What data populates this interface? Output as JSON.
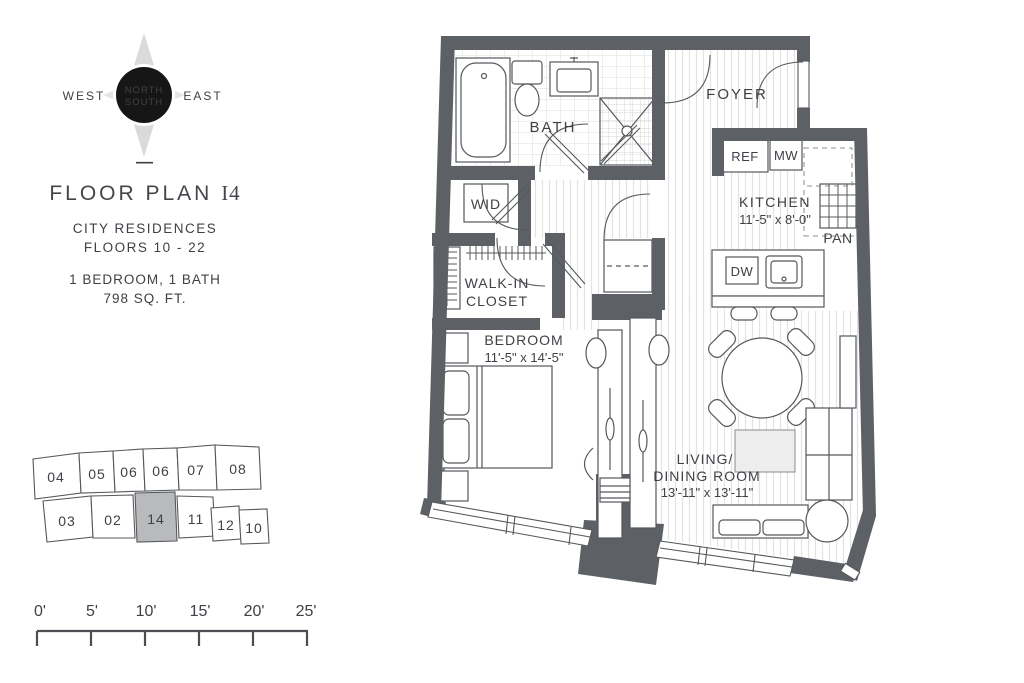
{
  "colors": {
    "wall": "#5d6165",
    "line": "#55585c",
    "text": "#3e4145",
    "highlight_unit": "#b9babc",
    "floor_hatch": "#e3e3e4"
  },
  "compass": {
    "north": "NORTH",
    "south": "SOUTH",
    "west": "WEST",
    "east": "EAST"
  },
  "title_block": {
    "divider": "—",
    "title_prefix": "FLOOR PLAN ",
    "title_unit": "I4",
    "building": "CITY RESIDENCES",
    "floors": "FLOORS 10 - 22",
    "bed_bath": "1 BEDROOM, 1 BATH",
    "area": "798 SQ. FT."
  },
  "key_plan": {
    "highlighted_unit": "14",
    "units": [
      "04",
      "05",
      "06",
      "06",
      "07",
      "08",
      "03",
      "02",
      "14",
      "11",
      "12",
      "10"
    ]
  },
  "scale_bar": {
    "labels": [
      "0'",
      "5'",
      "10'",
      "15'",
      "20'",
      "25'"
    ]
  },
  "floor_plan": {
    "rooms": {
      "bath": "BATH",
      "foyer": "FOYER",
      "kitchen_name": "KITCHEN",
      "kitchen_dims": "11'-5\" x 8'-0\"",
      "walkin_line1": "WALK-IN",
      "walkin_line2": "CLOSET",
      "bedroom_name": "BEDROOM",
      "bedroom_dims": "11'-5\" x 14'-5\"",
      "living_line1": "LIVING/",
      "living_line2": "DINING ROOM",
      "living_dims": "13'-11\" x 13'-11\""
    },
    "fixtures": {
      "wid": "WID",
      "ref": "REF",
      "mw": "MW",
      "pan": "PAN",
      "dw": "DW"
    }
  }
}
